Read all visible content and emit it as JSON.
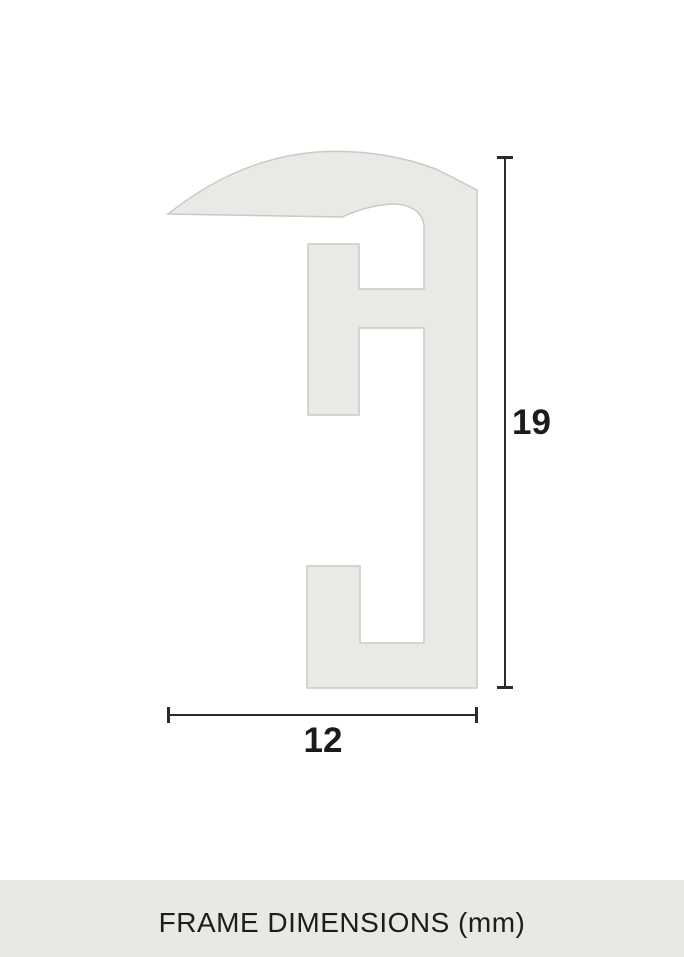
{
  "diagram": {
    "subject": "picture-frame-profile-cross-section",
    "height_dimension": {
      "value": "19"
    },
    "width_dimension": {
      "value": "12"
    }
  },
  "footer": {
    "caption": "FRAME DIMENSIONS (mm)"
  },
  "colors": {
    "background": "#ffffff",
    "shape_fill": "#e9eae6",
    "shape_stroke": "#c9c9c5",
    "dim_line": "#2b2b2b",
    "dim_text": "#1b1b1b",
    "footer_bg": "#e9e8e4",
    "footer_text": "#1d1d1b"
  }
}
